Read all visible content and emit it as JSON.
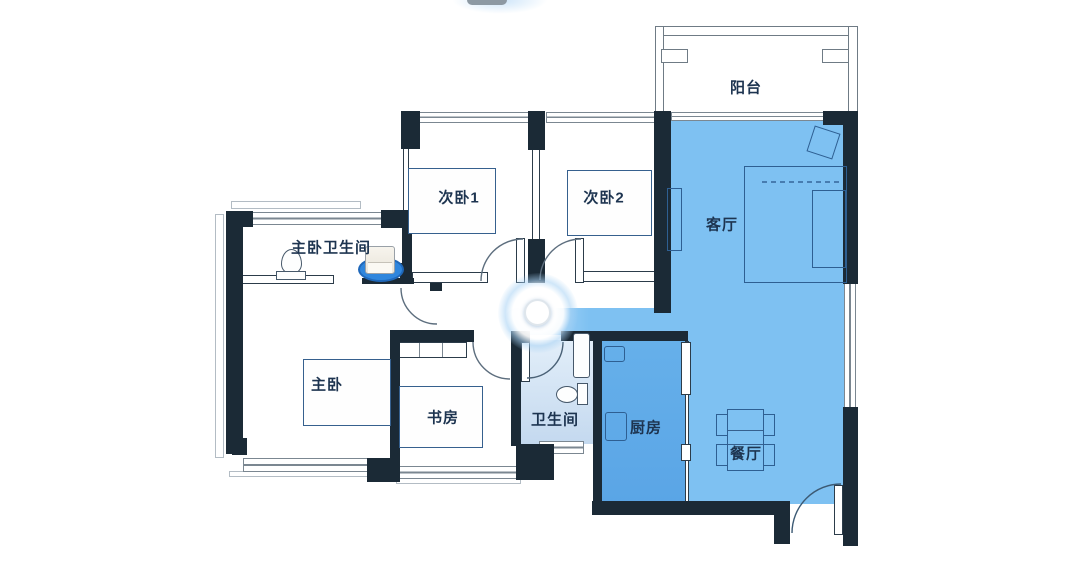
{
  "app": {
    "view": "apartment-floor-plan",
    "description": "floor plan with highlighted cleaning zones, robot dock and robot position marker"
  },
  "rooms": [
    {
      "id": "balcony",
      "label": "阳台",
      "highlighted": false
    },
    {
      "id": "bedroom-1",
      "label": "次卧1",
      "highlighted": false
    },
    {
      "id": "bedroom-2",
      "label": "次卧2",
      "highlighted": false
    },
    {
      "id": "living-room",
      "label": "客厅",
      "highlighted": true
    },
    {
      "id": "master-bath",
      "label": "主卧卫生间",
      "highlighted": false
    },
    {
      "id": "master-bedroom",
      "label": "主卧",
      "highlighted": false
    },
    {
      "id": "study",
      "label": "书房",
      "highlighted": false
    },
    {
      "id": "bathroom",
      "label": "卫生间",
      "highlighted": true
    },
    {
      "id": "kitchen",
      "label": "厨房",
      "highlighted": true
    },
    {
      "id": "dining-room",
      "label": "餐厅",
      "highlighted": true
    }
  ],
  "colors": {
    "wall": "#1b2a36",
    "living_dining_fill": "#7ec1f2",
    "kitchen_fill": "#5fa9e7",
    "bathroom_fill": "#cfe0f2",
    "dock_glow": "#2f86dd",
    "label_text": "#1d3450",
    "furniture_outline": "#2e5f92",
    "background": "#ffffff"
  },
  "icons": {
    "robot_marker": "glowing-circle",
    "dock": "charging-dock-on-blue-pad",
    "toilet": "toilet-shape",
    "door": "quarter-arc"
  }
}
